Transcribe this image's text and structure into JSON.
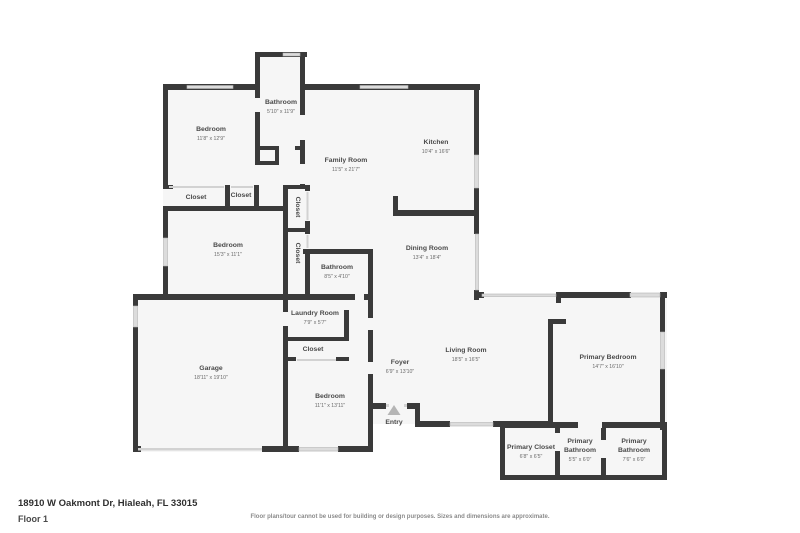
{
  "floorplan": {
    "colors": {
      "wall": "#3a3a3a",
      "floor": "#f6f6f6",
      "window_fill": "#dcdcdc",
      "window_stroke": "#b5b5b5",
      "room_name": "#4a4a4a",
      "room_dims": "#6b6b6b",
      "entry_triangle": "#b5b5b5"
    },
    "rooms": [
      {
        "id": "bathroom-top",
        "lines": [
          "Bathroom"
        ],
        "dims": "5'10\" x 11'9\"",
        "x": 281,
        "y": 104,
        "rot": 0
      },
      {
        "id": "bedroom-1",
        "lines": [
          "Bedroom"
        ],
        "dims": "11'8\" x 12'9\"",
        "x": 211,
        "y": 131,
        "rot": 0
      },
      {
        "id": "family-room",
        "lines": [
          "Family Room"
        ],
        "dims": "11'5\" x 21'7\"",
        "x": 346,
        "y": 162,
        "rot": 0
      },
      {
        "id": "kitchen",
        "lines": [
          "Kitchen"
        ],
        "dims": "10'4\" x 16'6\"",
        "x": 436,
        "y": 144,
        "rot": 0
      },
      {
        "id": "closet-1",
        "lines": [
          "Closet"
        ],
        "dims": "",
        "x": 196,
        "y": 199,
        "rot": 0
      },
      {
        "id": "closet-2",
        "lines": [
          "Closet"
        ],
        "dims": "",
        "x": 241,
        "y": 197,
        "rot": 0
      },
      {
        "id": "closet-3",
        "lines": [
          "Closet"
        ],
        "dims": "",
        "x": 296,
        "y": 207,
        "rot": 90
      },
      {
        "id": "bedroom-2",
        "lines": [
          "Bedroom"
        ],
        "dims": "15'3\" x 11'1\"",
        "x": 228,
        "y": 247,
        "rot": 0
      },
      {
        "id": "closet-4",
        "lines": [
          "Closet"
        ],
        "dims": "",
        "x": 296,
        "y": 253,
        "rot": 90
      },
      {
        "id": "bathroom-2",
        "lines": [
          "Bathroom"
        ],
        "dims": "8'5\" x 4'10\"",
        "x": 337,
        "y": 269,
        "rot": 0
      },
      {
        "id": "dining-room",
        "lines": [
          "Dining Room"
        ],
        "dims": "13'4\" x 18'4\"",
        "x": 427,
        "y": 250,
        "rot": 0
      },
      {
        "id": "laundry-room",
        "lines": [
          "Laundry Room"
        ],
        "dims": "7'9\" x 5'7\"",
        "x": 315,
        "y": 315,
        "rot": 0
      },
      {
        "id": "garage",
        "lines": [
          "Garage"
        ],
        "dims": "18'11\" x 19'10\"",
        "x": 211,
        "y": 370,
        "rot": 0
      },
      {
        "id": "closet-5",
        "lines": [
          "Closet"
        ],
        "dims": "",
        "x": 313,
        "y": 351,
        "rot": 0
      },
      {
        "id": "bedroom-3",
        "lines": [
          "Bedroom"
        ],
        "dims": "11'1\" x 13'11\"",
        "x": 330,
        "y": 398,
        "rot": 0
      },
      {
        "id": "foyer",
        "lines": [
          "Foyer"
        ],
        "dims": "6'9\" x 13'10\"",
        "x": 400,
        "y": 364,
        "rot": 0
      },
      {
        "id": "living-room",
        "lines": [
          "Living Room"
        ],
        "dims": "18'5\" x 16'5\"",
        "x": 466,
        "y": 352,
        "rot": 0
      },
      {
        "id": "primary-bedroom",
        "lines": [
          "Primary Bedroom"
        ],
        "dims": "14'7\" x 16'10\"",
        "x": 608,
        "y": 359,
        "rot": 0
      },
      {
        "id": "primary-closet",
        "lines": [
          "Primary Closet"
        ],
        "dims": "6'8\" x 6'5\"",
        "x": 531,
        "y": 449,
        "rot": 0
      },
      {
        "id": "primary-bathroom-1",
        "lines": [
          "Primary",
          "Bathroom"
        ],
        "dims": "5'5\" x 6'0\"",
        "x": 580,
        "y": 443,
        "rot": 0
      },
      {
        "id": "primary-bathroom-2",
        "lines": [
          "Primary",
          "Bathroom"
        ],
        "dims": "7'6\" x 6'0\"",
        "x": 634,
        "y": 443,
        "rot": 0
      }
    ],
    "entry": {
      "label": "Entry",
      "x": 394,
      "y": 424
    },
    "footer": {
      "address": "18910 W Oakmont Dr, Hialeah, FL 33015",
      "floor": "Floor 1",
      "disclaimer": "Floor plans/tour cannot be used for building or design purposes. Sizes and dimensions are approximate."
    }
  }
}
